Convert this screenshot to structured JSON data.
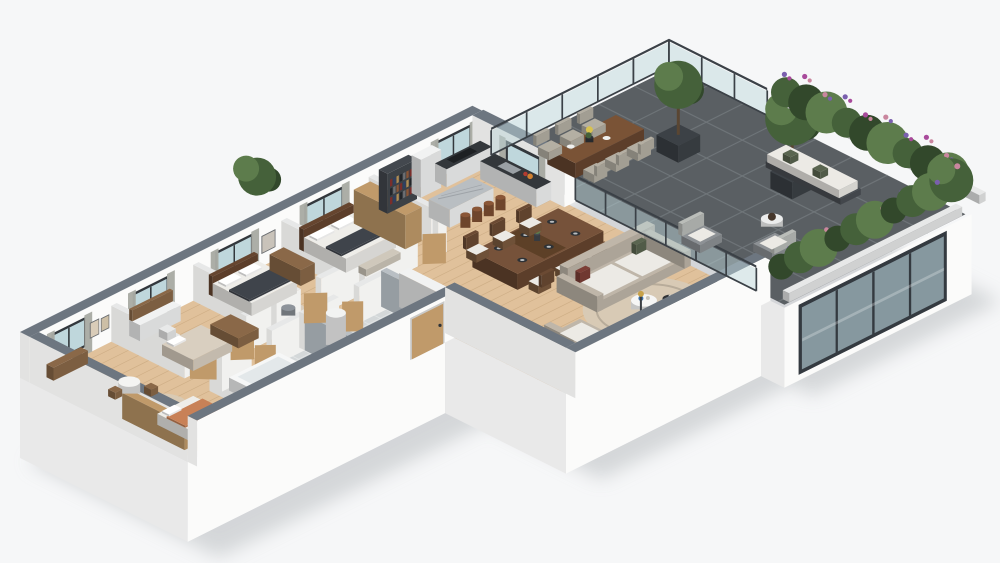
{
  "scene": {
    "type": "isometric-3d-floorplan-render",
    "objects": [
      "ground-shadow",
      "building-base",
      "glass-sliding-door",
      "wood-floor",
      "bathroom-floor",
      "terrace-floor",
      "nursery-bedroom",
      "bedroom-desk",
      "bedroom-double",
      "master-bedroom",
      "bathroom-bathtub",
      "bathroom-wc",
      "corridor",
      "kitchen",
      "kitchen-island",
      "bar-stools",
      "bookshelf",
      "dining-table",
      "dining-chairs",
      "entry-hall",
      "living-sofa",
      "armchair",
      "round-rug",
      "coffee-table",
      "tv-unit",
      "entrance-door",
      "glass-balustrade",
      "terrace-dining-set",
      "terrace-trees",
      "terrace-lounge",
      "outdoor-sofa",
      "flower-hedge"
    ]
  },
  "colors": {
    "background": "#f6f7f8",
    "ground_shadow": "#c9cccf",
    "exterior_wall_top": "#6d7680",
    "exterior_wall_face": "#fbfbfa",
    "interior_wall": "#f1f1ef",
    "interior_wall_top": "#e7e8e8",
    "bath_wall": "#a7aeb4",
    "bath_wall_top": "#b9bfc4",
    "wood_floor": "#e0c19b",
    "plank_line": "#bd9c73",
    "bath_floor": "#d4d8d9",
    "terrace_tile": "#5a5f63",
    "terrace_grout": "#71777b",
    "glass": "#bfd7dc",
    "glass_door_dark": "#86989f",
    "glass_frame": "#343a40",
    "window_frame": "#33383d",
    "curtain": "#a9aba4",
    "door_wood": "#c09a6a",
    "furniture_wood": "#8a6848",
    "dark_wood": "#66452f",
    "sofa_beige": "#bfb6a9",
    "cushion_white": "#eceae5",
    "accent_pillow": "#7c3e36",
    "accent_green": "#5a6550",
    "rug_beige": "#d8cab5",
    "bed_dark": "#3f444b",
    "bed_white": "#eeede9",
    "kid_blanket": "#c88157",
    "counter_dark": "#33373b",
    "marble": "#b9bec2",
    "stool_leather": "#8a5637",
    "appliance_white": "#f1f2f2",
    "tub_white": "#f6f7f7",
    "foliage": "#45613a",
    "foliage_dark": "#32482b",
    "foliage_light": "#5d7c4c",
    "flower_purple": "#7a5fae",
    "flower_magenta": "#a84a9b",
    "flower_pink": "#c9869e",
    "flower_yellow": "#d8c24f",
    "planter_dark": "#3c4146",
    "planter_white": "#e7e8e8",
    "wicker": "#b4afa3",
    "tv_black": "#16181a",
    "metal_dark": "#3b4147",
    "trunk_brown": "#5a4632",
    "book_colors": [
      "#7a2e2b",
      "#2e3f63",
      "#b08d55",
      "#23262a",
      "#6d6f72",
      "#8a5637"
    ]
  }
}
